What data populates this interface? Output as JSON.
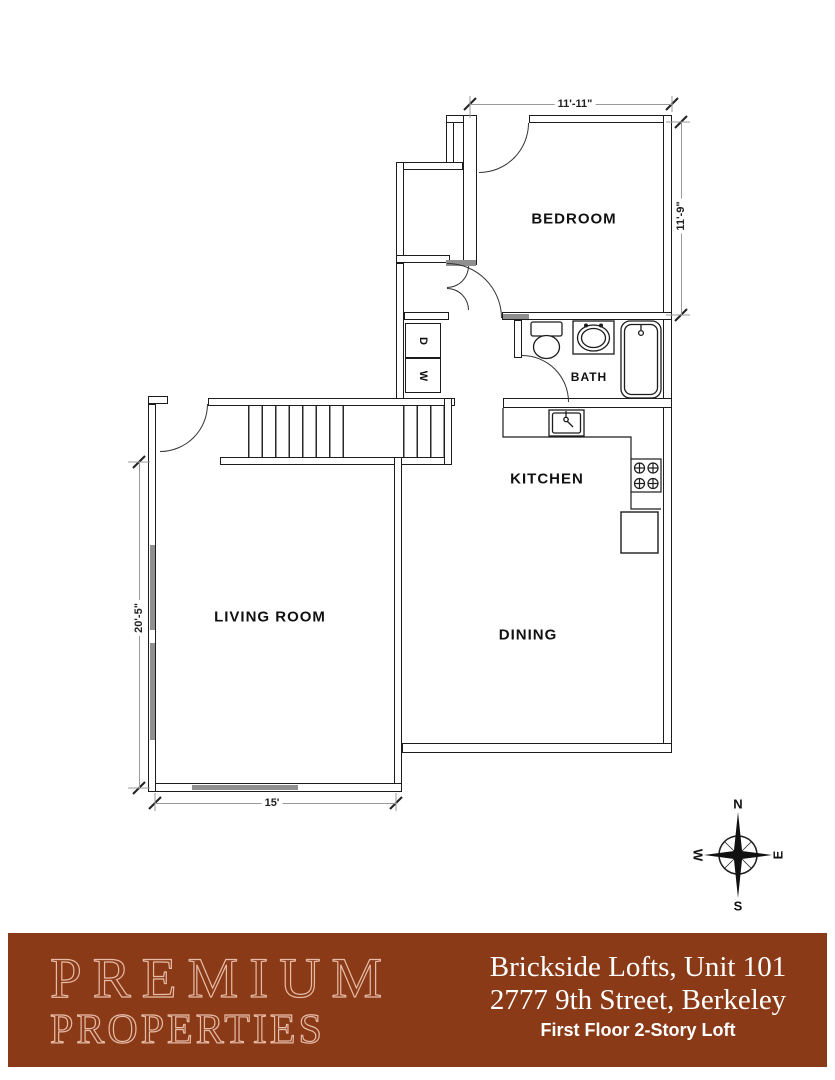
{
  "plan": {
    "rooms": {
      "bedroom": "BEDROOM",
      "bath": "BATH",
      "kitchen": "KITCHEN",
      "dining": "DINING",
      "living": "LIVING ROOM"
    },
    "appliances": {
      "dryer": "D",
      "washer": "W"
    },
    "dimensions": {
      "bedroom_width": "11'-11\"",
      "bedroom_depth": "11'-9\"",
      "living_depth": "20'-5\"",
      "living_width": "15'"
    },
    "compass": {
      "north": "N",
      "south": "S",
      "east": "E",
      "west": "W"
    }
  },
  "banner": {
    "brand_line1": "PREMIUM",
    "brand_line2": "PROPERTIES",
    "title": "Brickside Lofts, Unit 101",
    "address": "2777 9th Street, Berkeley",
    "subtitle": "First Floor 2-Story Loft",
    "colors": {
      "background": "#8a3a17",
      "brand_text": "#e6bba7",
      "title_text": "#ffffff"
    }
  }
}
